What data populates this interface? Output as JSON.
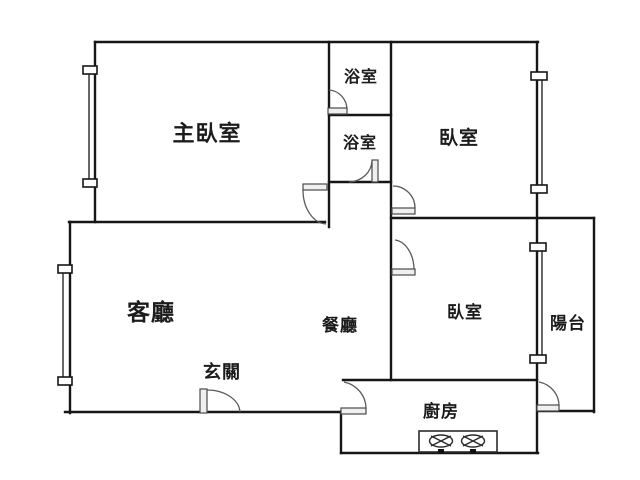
{
  "plan_title": "apartment-floor-plan",
  "colors": {
    "background": "#ffffff",
    "wall": "#161616",
    "door": "#5a5a5a",
    "text": "#1c1c1c"
  },
  "rooms": [
    {
      "id": "master-bedroom",
      "label": "主臥室"
    },
    {
      "id": "bathroom-upper",
      "label": "浴室"
    },
    {
      "id": "bathroom-lower",
      "label": "浴室"
    },
    {
      "id": "bedroom-upper-right",
      "label": "臥室"
    },
    {
      "id": "living-room",
      "label": "客廳"
    },
    {
      "id": "dining-room",
      "label": "餐廳"
    },
    {
      "id": "bedroom-lower-right",
      "label": "臥室"
    },
    {
      "id": "balcony",
      "label": "陽台"
    },
    {
      "id": "entry",
      "label": "玄關"
    },
    {
      "id": "kitchen",
      "label": "廚房"
    }
  ],
  "fixtures": {
    "stove": {
      "name": "two-burner-stove",
      "burners": 2
    },
    "windows": 4,
    "doors": 8
  }
}
